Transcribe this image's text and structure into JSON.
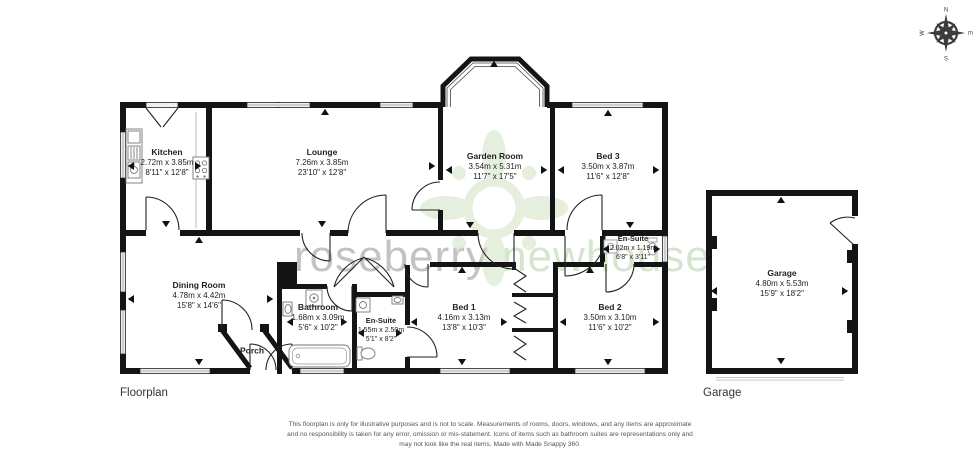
{
  "labels": {
    "floorplan": "Floorplan",
    "garage": "Garage"
  },
  "watermark": {
    "word1": "roseberry",
    "word2": "newhouse",
    "color1": "#b5b5b5",
    "color2": "#cbdfc2"
  },
  "compass": {
    "n": "N",
    "e": "E",
    "s": "S",
    "w": "W"
  },
  "wall_color": "#141414",
  "rooms": [
    {
      "name": "Kitchen",
      "metric": "2.72m x 3.85m",
      "imperial": "8'11\" x 12'8\""
    },
    {
      "name": "Lounge",
      "metric": "7.26m x 3.85m",
      "imperial": "23'10\" x 12'8\""
    },
    {
      "name": "Garden Room",
      "metric": "3.54m x 5.31m",
      "imperial": "11'7\" x 17'5\""
    },
    {
      "name": "Bed 3",
      "metric": "3.50m x 3.87m",
      "imperial": "11'6\" x 12'8\""
    },
    {
      "name": "En-Suite",
      "metric": "2.02m x 1.19m",
      "imperial": "6'8\" x 3'11\""
    },
    {
      "name": "Dining Room",
      "metric": "4.78m x 4.42m",
      "imperial": "15'8\" x 14'6\""
    },
    {
      "name": "Porch"
    },
    {
      "name": "Bathroom",
      "metric": "1.68m x 3.09m",
      "imperial": "5'6\" x 10'2\""
    },
    {
      "name": "En-Suite",
      "metric": "1.55m x 2.50m",
      "imperial": "5'1\" x 8'2\""
    },
    {
      "name": "Bed 1",
      "metric": "4.16m x 3.13m",
      "imperial": "13'8\" x 10'3\""
    },
    {
      "name": "Bed 2",
      "metric": "3.50m x 3.10m",
      "imperial": "11'6\" x 10'2\""
    },
    {
      "name": "Garage",
      "metric": "4.80m x 5.53m",
      "imperial": "15'9\" x 18'2\""
    }
  ],
  "disclaimer": {
    "line1": "This floorplan is only for illustrative purposes and is not to scale. Measurements of rooms, doors, windows, and any items are approximate",
    "line2": "and no responsibility is taken for any error, omission or mis-statement. Icons of items such as bathroom suites are representations only and",
    "line3": "may not look like the real items. Made with Made Snappy 360."
  }
}
